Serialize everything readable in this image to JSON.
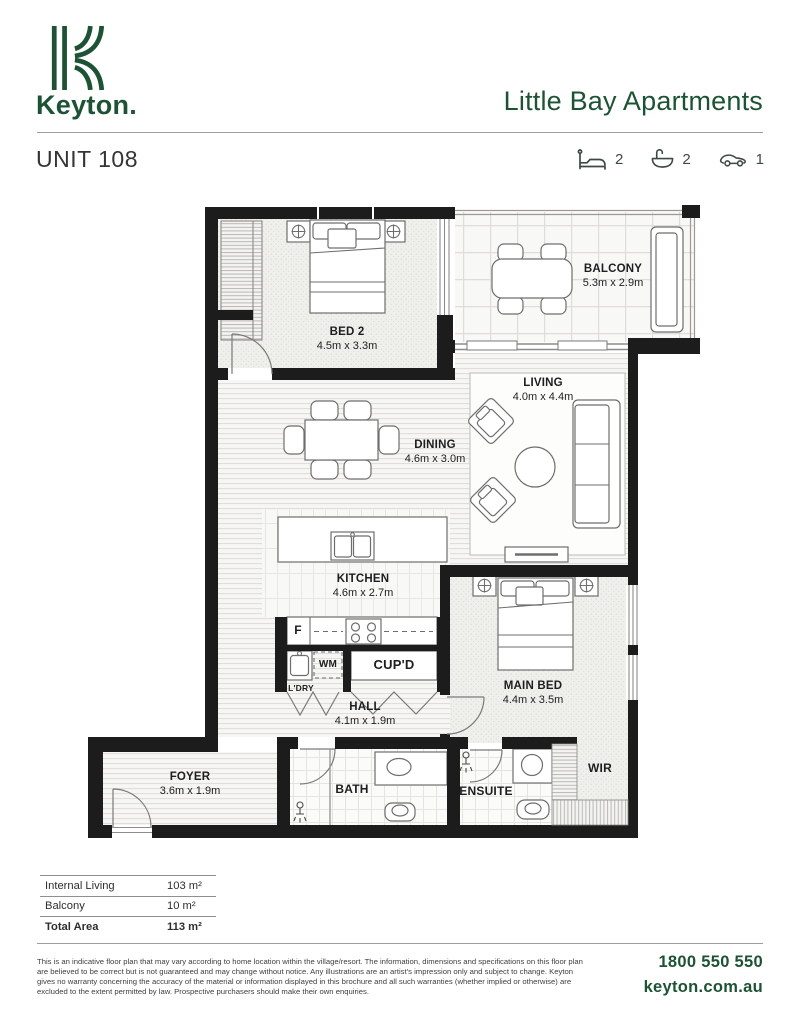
{
  "brand": {
    "name": "Keyton.",
    "project": "Little Bay Apartments"
  },
  "unit": {
    "title": "UNIT 108"
  },
  "stats": {
    "beds": "2",
    "baths": "2",
    "cars": "1",
    "icons": [
      "bed-icon",
      "bath-icon",
      "car-icon"
    ]
  },
  "rooms": {
    "bed2": {
      "name": "BED 2",
      "dims": "4.5m x 3.3m"
    },
    "balcony": {
      "name": "BALCONY",
      "dims": "5.3m x 2.9m"
    },
    "living": {
      "name": "LIVING",
      "dims": "4.0m x 4.4m"
    },
    "dining": {
      "name": "DINING",
      "dims": "4.6m x 3.0m"
    },
    "kitchen": {
      "name": "KITCHEN",
      "dims": "4.6m x 2.7m"
    },
    "hall": {
      "name": "HALL",
      "dims": "4.1m x 1.9m"
    },
    "main_bed": {
      "name": "MAIN BED",
      "dims": "4.4m x 3.5m"
    },
    "foyer": {
      "name": "FOYER",
      "dims": "3.6m x 1.9m"
    },
    "bath": {
      "name": "BATH"
    },
    "ensuite": {
      "name": "ENSUITE"
    },
    "wir": {
      "name": "WIR"
    },
    "cupboard": {
      "name": "CUP'D"
    },
    "laundry": {
      "name": "L'DRY"
    },
    "washing_machine": {
      "name": "WM"
    },
    "fridge": {
      "name": "F"
    }
  },
  "areas": {
    "rows": [
      {
        "label": "Internal Living",
        "value": "103 m²"
      },
      {
        "label": "Balcony",
        "value": "10 m²"
      },
      {
        "label": "Total Area",
        "value": "113 m²"
      }
    ]
  },
  "footer": {
    "disclaimer": "This is an indicative floor plan that may vary according to home location within the village/resort. The information, dimensions and specifications on this floor plan are believed to be correct but is not guaranteed and may change without notice. Any illustrations are an artist's impression only and subject to change. Keyton gives no warranty concerning the accuracy of the material or information displayed in this brochure and all such warranties (whether implied or otherwise) are excluded to the extent permitted by law. Prospective purchasers should make their own enquiries.",
    "phone": "1800 550 550",
    "website": "keyton.com.au"
  },
  "colors": {
    "brand_green": "#1d5334",
    "icon_green": "#3d4a41",
    "wall": "#1c1c1c"
  }
}
